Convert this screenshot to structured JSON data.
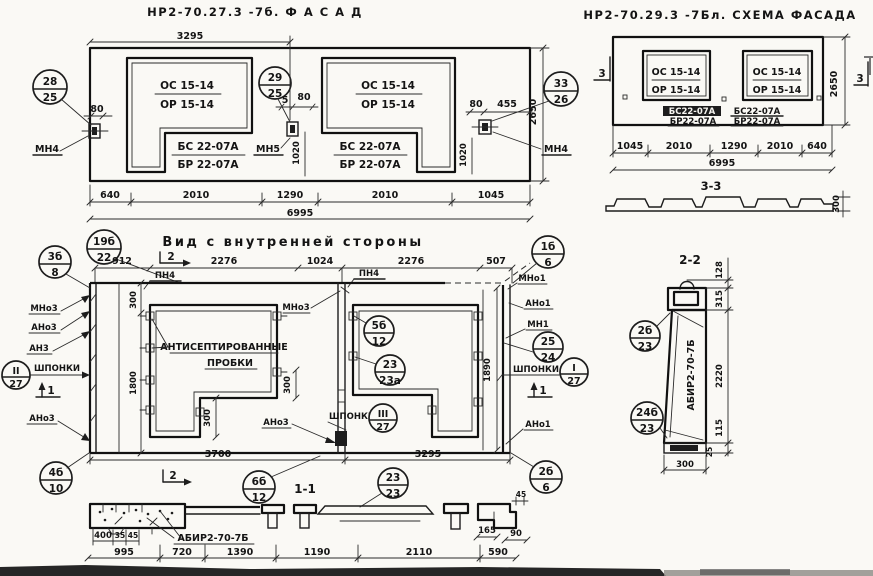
{
  "facade": {
    "title": "НР2-70.27.3 -7б.  Ф А С А Д",
    "os": "ОС 15-14",
    "or": "ОР 15-14",
    "bs": "БС 22-07А",
    "br": "БР 22-07А",
    "mn4": "МН4",
    "mn5": "МН5",
    "callouts": {
      "c28": {
        "top": "28",
        "bot": "25"
      },
      "c29": {
        "top": "29",
        "bot": "25"
      },
      "c33": {
        "top": "33",
        "bot": "26"
      }
    },
    "dims": {
      "top_span": "3295",
      "edge80": "80",
      "gap5": "5",
      "mid80": "80",
      "right80": "80",
      "right455": "455",
      "v1020": "1020",
      "height": "2650",
      "b640": "640",
      "b2010": "2010",
      "b1290": "1290",
      "b1045": "1045",
      "total": "6995"
    }
  },
  "scheme": {
    "title": "НР2-70.29.3 -7Бл. СХЕМА ФАСАДА",
    "os": "ОС 15-14",
    "or": "ОР 15-14",
    "bs": "БС22-07А",
    "br": "БР22-07А",
    "sec3": "3",
    "sec33_title": "3-3",
    "dims": {
      "height": "2650",
      "b1045": "1045",
      "b2010": "2010",
      "b1290": "1290",
      "b640": "640",
      "total": "6995",
      "thickness": "300"
    }
  },
  "internal": {
    "title": "Вид с внутренней стороны",
    "plugs1": "АНТИСЕПТИРОВАННЫЕ",
    "plugs2": "ПРОБКИ",
    "shponki": "ШПОНКИ",
    "pn4": "ПН4",
    "mno3": "МНо3",
    "ano3": "АНо3",
    "an3": "АН3",
    "mno1": "МНо1",
    "ano1": "АНо1",
    "mn1": "МН1",
    "m1": "1",
    "m2": "2",
    "sec11_title": "1-1",
    "callouts": {
      "c19": {
        "top": "19б",
        "bot": "22"
      },
      "c3b": {
        "top": "3б",
        "bot": "8"
      },
      "c4b": {
        "top": "4б",
        "bot": "10"
      },
      "c1b": {
        "top": "1б",
        "bot": "6"
      },
      "c5b": {
        "top": "5б",
        "bot": "12"
      },
      "c23a": {
        "top": "23",
        "bot": "23а"
      },
      "c25": {
        "top": "25",
        "bot": "24"
      },
      "cI": {
        "top": "I",
        "bot": "27"
      },
      "cII": {
        "top": "II",
        "bot": "27"
      },
      "cIII": {
        "top": "III",
        "bot": "27"
      },
      "c6b": {
        "top": "6б",
        "bot": "12"
      },
      "c23": {
        "top": "23",
        "bot": "23"
      },
      "c2b6": {
        "top": "2б",
        "bot": "6"
      }
    },
    "dims": {
      "d912": "912",
      "d2276": "2276",
      "d1024": "1024",
      "d507": "507",
      "d300": "300",
      "d1800": "1800",
      "d1890": "1890",
      "d3700": "3700",
      "d3295": "3295"
    }
  },
  "sec22": {
    "title": "2-2",
    "label": "АБИР2-70-7Б",
    "dims": {
      "d128": "128",
      "d315": "315",
      "d2220": "2220",
      "d115": "115",
      "d25": "25",
      "d300": "300"
    },
    "callouts": {
      "c2b": {
        "top": "2б",
        "bot": "23"
      },
      "c24b": {
        "top": "24б",
        "bot": "23"
      }
    }
  },
  "sec11": {
    "label": "АБИР2-70-7Б",
    "dims": {
      "d400": "400",
      "d35": "35",
      "d45": "45",
      "d45b": "45",
      "d995": "995",
      "d720": "720",
      "d1390": "1390",
      "d1190": "1190",
      "d2110": "2110",
      "d590": "590",
      "d165": "165",
      "d90": "90"
    }
  }
}
